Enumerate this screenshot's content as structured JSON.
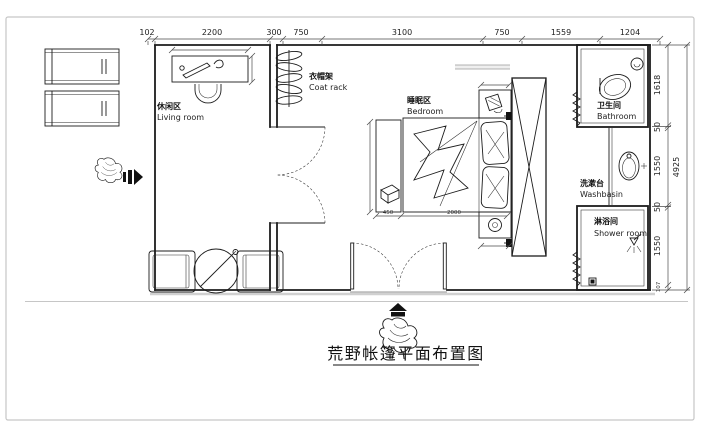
{
  "title": "荒野帐篷平面布置图",
  "dims": {
    "top": [
      "102",
      "2200",
      "300",
      "750",
      "3100",
      "750",
      "1559",
      "1204"
    ],
    "right": [
      "1618",
      "50",
      "1550",
      "50",
      "1550",
      "107"
    ],
    "right_total": "4925",
    "bed": [
      "450",
      "2000"
    ]
  },
  "rooms": {
    "living": {
      "zh": "休闲区",
      "en": "Living room"
    },
    "coat_rack": {
      "zh": "衣帽架",
      "en": "Coat rack"
    },
    "bedroom": {
      "zh": "睡眠区",
      "en": "Bedroom"
    },
    "bathroom": {
      "zh": "卫生间",
      "en": "Bathroom"
    },
    "washbasin": {
      "zh": "洗漱台",
      "en": "Washbasin"
    },
    "shower": {
      "zh": "淋浴间",
      "en": "Shower room"
    }
  },
  "colors": {
    "line": "#1c1c1c",
    "dim_text": "#222222",
    "gray": "#c6c6c6",
    "bg": "#ffffff"
  }
}
